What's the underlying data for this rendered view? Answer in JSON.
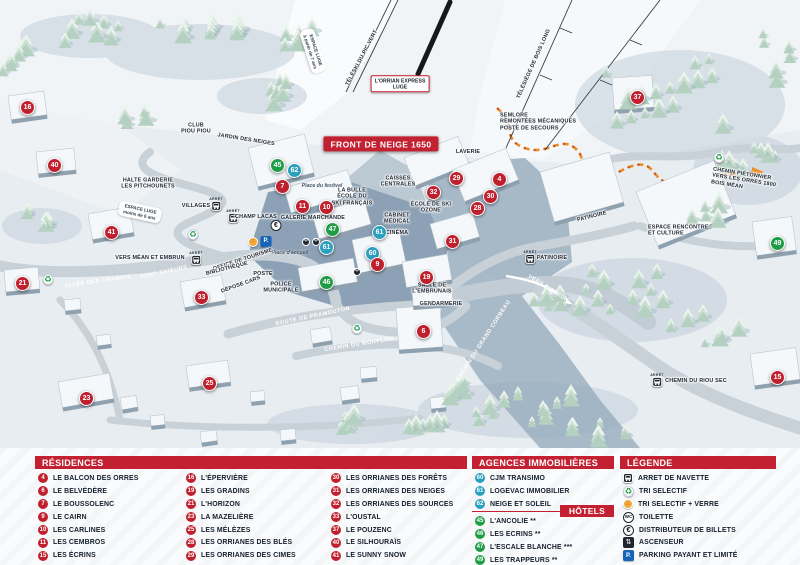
{
  "colors": {
    "red": "#c32032",
    "green": "#1f9d46",
    "teal": "#2b9fbe",
    "trail-orange": "#ee8c25"
  },
  "map": {
    "arret_label": "ARRÊT",
    "banner": "FRONT DE NEIGE 1650",
    "markers": [
      {
        "n": "16",
        "x": 28,
        "y": 108,
        "c": "red"
      },
      {
        "n": "40",
        "x": 55,
        "y": 166,
        "c": "red"
      },
      {
        "n": "41",
        "x": 112,
        "y": 233,
        "c": "red"
      },
      {
        "n": "21",
        "x": 23,
        "y": 284,
        "c": "red"
      },
      {
        "n": "23",
        "x": 87,
        "y": 399,
        "c": "red"
      },
      {
        "n": "25",
        "x": 210,
        "y": 384,
        "c": "red"
      },
      {
        "n": "33",
        "x": 202,
        "y": 298,
        "c": "red"
      },
      {
        "n": "45",
        "x": 278,
        "y": 166,
        "c": "green"
      },
      {
        "n": "62",
        "x": 295,
        "y": 171,
        "c": "teal"
      },
      {
        "n": "7",
        "x": 283,
        "y": 187,
        "c": "red"
      },
      {
        "n": "11",
        "x": 303,
        "y": 207,
        "c": "red"
      },
      {
        "n": "10",
        "x": 327,
        "y": 208,
        "c": "red"
      },
      {
        "n": "47",
        "x": 333,
        "y": 230,
        "c": "green"
      },
      {
        "n": "61",
        "x": 380,
        "y": 233,
        "c": "teal"
      },
      {
        "n": "61",
        "x": 327,
        "y": 248,
        "c": "teal"
      },
      {
        "n": "60",
        "x": 373,
        "y": 254,
        "c": "teal"
      },
      {
        "n": "9",
        "x": 378,
        "y": 265,
        "c": "red"
      },
      {
        "n": "46",
        "x": 327,
        "y": 283,
        "c": "green"
      },
      {
        "n": "19",
        "x": 427,
        "y": 278,
        "c": "red"
      },
      {
        "n": "29",
        "x": 457,
        "y": 179,
        "c": "red"
      },
      {
        "n": "32",
        "x": 434,
        "y": 193,
        "c": "red"
      },
      {
        "n": "30",
        "x": 491,
        "y": 197,
        "c": "red"
      },
      {
        "n": "28",
        "x": 478,
        "y": 209,
        "c": "red"
      },
      {
        "n": "4",
        "x": 500,
        "y": 180,
        "c": "red"
      },
      {
        "n": "31",
        "x": 453,
        "y": 242,
        "c": "red"
      },
      {
        "n": "6",
        "x": 424,
        "y": 332,
        "c": "red"
      },
      {
        "n": "37",
        "x": 638,
        "y": 98,
        "c": "red"
      },
      {
        "n": "49",
        "x": 778,
        "y": 244,
        "c": "green"
      },
      {
        "n": "15",
        "x": 778,
        "y": 378,
        "c": "red"
      }
    ],
    "labels": [
      {
        "t": "CLUB\nPIOU PIOU",
        "x": 196,
        "y": 129,
        "s": "dark"
      },
      {
        "t": "JARDIN DES NEIGES",
        "x": 246,
        "y": 140,
        "s": "dark",
        "r": 9
      },
      {
        "t": "ESPACE LUGE\nà partir de 7 ans",
        "x": 313,
        "y": 51,
        "s": "whitebox",
        "r": 72
      },
      {
        "t": "TÉLÉSKI DU PIC VERT",
        "x": 362,
        "y": 58,
        "s": "dark",
        "r": -62
      },
      {
        "t": "L'ORRIAN EXPRESS\nLUGE",
        "x": 400,
        "y": 84,
        "s": "redbox"
      },
      {
        "t": "TÉLÉSIÈGE DE BOIS LONG",
        "x": 534,
        "y": 64,
        "s": "dark",
        "r": -66
      },
      {
        "t": "SEMLORE\nREMONTÉES MÉCANIQUES\nPOSTE DE SECOURS",
        "x": 500,
        "y": 122,
        "s": "dark-left"
      },
      {
        "t": "FRONT DE NEIGE 1650",
        "x": 381,
        "y": 144,
        "s": "banner"
      },
      {
        "t": "LAVERIE",
        "x": 468,
        "y": 152,
        "s": "dark"
      },
      {
        "t": "HALTE GARDERIE\nLES PITCHOUNETS",
        "x": 148,
        "y": 184,
        "s": "dark"
      },
      {
        "t": "VILLAGES",
        "x": 196,
        "y": 206,
        "s": "dark"
      },
      {
        "t": "CHAMP LACAS",
        "x": 256,
        "y": 217,
        "s": "dark"
      },
      {
        "t": "ESPACE LUGE\nmoins de 6 ans",
        "x": 140,
        "y": 212,
        "s": "whitebox",
        "r": 12
      },
      {
        "t": "Place du festival",
        "x": 322,
        "y": 186,
        "s": "place"
      },
      {
        "t": "LA BULLE\nÉCOLE DU\nSKI FRANÇAIS",
        "x": 352,
        "y": 197,
        "s": "dark"
      },
      {
        "t": "GALERIE MARCHANDE",
        "x": 313,
        "y": 218,
        "s": "dark"
      },
      {
        "t": "CAISSES\nCENTRALES",
        "x": 398,
        "y": 182,
        "s": "dark"
      },
      {
        "t": "ÉCOLE DE SKI\nOZONE",
        "x": 431,
        "y": 208,
        "s": "dark"
      },
      {
        "t": "CABINET\nMÉDICAL",
        "x": 397,
        "y": 219,
        "s": "dark"
      },
      {
        "t": "CINÉMA",
        "x": 397,
        "y": 233,
        "s": "dark"
      },
      {
        "t": "PATINOIRE",
        "x": 592,
        "y": 217,
        "s": "dark",
        "r": -14
      },
      {
        "t": "ESPACE RENCONTRE\nET CULTURE",
        "x": 648,
        "y": 231,
        "s": "dark-left"
      },
      {
        "t": "PATINOIRE",
        "x": 552,
        "y": 258,
        "s": "dark"
      },
      {
        "t": "VERS EMBRUN",
        "x": 548,
        "y": 289,
        "s": "white",
        "r": 32
      },
      {
        "t": "CHEMIN PIÉTONNIER\nVERS LES ORRES 1800\nBOIS MÉAN",
        "x": 712,
        "y": 176,
        "s": "dark-left",
        "r": 9
      },
      {
        "t": "VERS MÉAN ET EMBRUN",
        "x": 150,
        "y": 258,
        "s": "dark"
      },
      {
        "t": "PONT SKIEURS",
        "x": 164,
        "y": 273,
        "s": "white",
        "r": -12
      },
      {
        "t": "ALLÉE DES CHAMOIS",
        "x": 98,
        "y": 282,
        "s": "white",
        "r": -8
      },
      {
        "t": "Place d'accueil",
        "x": 290,
        "y": 253,
        "s": "place"
      },
      {
        "t": "OFFICE DE TOURISME",
        "x": 243,
        "y": 260,
        "s": "dark",
        "r": -18
      },
      {
        "t": "BIBLIOTHÈQUE",
        "x": 227,
        "y": 269,
        "s": "dark",
        "r": -14
      },
      {
        "t": "POSTE",
        "x": 263,
        "y": 274,
        "s": "dark"
      },
      {
        "t": "DÉPOSE CARS",
        "x": 241,
        "y": 285,
        "s": "dark",
        "r": -20
      },
      {
        "t": "POLICE\nMUNICIPALE",
        "x": 281,
        "y": 288,
        "s": "dark"
      },
      {
        "t": "ROUTE DE PRAMOUTON",
        "x": 313,
        "y": 317,
        "s": "white",
        "r": -12
      },
      {
        "t": "CHEMIN DU MOUFLON",
        "x": 359,
        "y": 345,
        "s": "white",
        "r": -9
      },
      {
        "t": "CHEMIN DU GRAND CORBEAU",
        "x": 484,
        "y": 341,
        "s": "white",
        "r": -57
      },
      {
        "t": "SALLE DE\nL'EMBRUNAIS",
        "x": 432,
        "y": 289,
        "s": "dark"
      },
      {
        "t": "GENDARMERIE",
        "x": 441,
        "y": 304,
        "s": "dark"
      },
      {
        "t": "CHEMIN DU RIOU SEC",
        "x": 696,
        "y": 381,
        "s": "dark"
      }
    ],
    "bus_stops": [
      {
        "x": 216,
        "y": 205
      },
      {
        "x": 233,
        "y": 217
      },
      {
        "x": 196,
        "y": 259
      },
      {
        "x": 530,
        "y": 258
      },
      {
        "x": 657,
        "y": 381
      }
    ],
    "recycle_points": [
      {
        "x": 193,
        "y": 233
      },
      {
        "x": 48,
        "y": 278
      },
      {
        "x": 357,
        "y": 327
      },
      {
        "x": 719,
        "y": 156
      }
    ],
    "icons": [
      {
        "type": "euro",
        "x": 276,
        "y": 223
      },
      {
        "type": "glass",
        "x": 253,
        "y": 238
      },
      {
        "type": "parking",
        "x": 266,
        "y": 238
      },
      {
        "type": "restaurant",
        "x": 306,
        "y": 238
      },
      {
        "type": "restaurant",
        "x": 316,
        "y": 238
      },
      {
        "type": "restaurant",
        "x": 357,
        "y": 268
      }
    ]
  },
  "legend": {
    "residences": {
      "title": "RÉSIDENCES",
      "items": [
        {
          "n": "4",
          "label": "LE BALCON DES ORRES"
        },
        {
          "n": "6",
          "label": "LE BELVÉDÈRE"
        },
        {
          "n": "7",
          "label": "LE BOUSSOLENC"
        },
        {
          "n": "9",
          "label": "LE CAIRN"
        },
        {
          "n": "10",
          "label": "LES CARLINES"
        },
        {
          "n": "11",
          "label": "LES CEMBROS"
        },
        {
          "n": "15",
          "label": "LES ÉCRINS"
        },
        {
          "n": "16",
          "label": "L'ÉPERVIÈRE"
        },
        {
          "n": "19",
          "label": "LES GRADINS"
        },
        {
          "n": "21",
          "label": "L'HORIZON"
        },
        {
          "n": "23",
          "label": "LA MAZELIÈRE"
        },
        {
          "n": "25",
          "label": "LES MÉLÈZES"
        },
        {
          "n": "28",
          "label": "LES ORRIANES DES BLÉS"
        },
        {
          "n": "29",
          "label": "LES ORRIANES DES CIMES"
        },
        {
          "n": "30",
          "label": "LES ORRIANES DES FORÊTS"
        },
        {
          "n": "31",
          "label": "LES ORRIANES DES NEIGES"
        },
        {
          "n": "32",
          "label": "LES ORRIANES DES SOURCES"
        },
        {
          "n": "33",
          "label": "L'OUSTAL"
        },
        {
          "n": "37",
          "label": "LE POUZENC"
        },
        {
          "n": "40",
          "label": "LE SILHOURAÏS"
        },
        {
          "n": "41",
          "label": "LE SUNNY SNOW"
        }
      ]
    },
    "agences": {
      "title": "AGENCES IMMOBILIÈRES",
      "items": [
        {
          "n": "60",
          "label": "CJM TRANSIMO"
        },
        {
          "n": "61",
          "label": "LOGEVAC IMMOBILIER"
        },
        {
          "n": "62",
          "label": "NEIGE ET SOLEIL"
        }
      ]
    },
    "hotels": {
      "title": "HÔTELS",
      "items": [
        {
          "n": "45",
          "label": "L'ANCOLIE **"
        },
        {
          "n": "46",
          "label": "LES ECRINS **"
        },
        {
          "n": "47",
          "label": "L'ESCALE BLANCHE ***"
        },
        {
          "n": "49",
          "label": "LES TRAPPEURS **"
        }
      ]
    },
    "legende": {
      "title": "LÉGENDE",
      "items": [
        {
          "icon": "bus",
          "label": "ARRET DE NAVETTE"
        },
        {
          "icon": "recycle",
          "label": "TRI SELECTIF"
        },
        {
          "icon": "glass",
          "label": "TRI SELECTIF + VERRE"
        },
        {
          "icon": "wc",
          "label": "TOILETTE"
        },
        {
          "icon": "euro",
          "label": "DISTRIBUTEUR DE BILLETS"
        },
        {
          "icon": "elevator",
          "label": "ASCENSEUR"
        },
        {
          "icon": "parking",
          "label": "PARKING PAYANT ET LIMITÉ"
        }
      ]
    }
  }
}
